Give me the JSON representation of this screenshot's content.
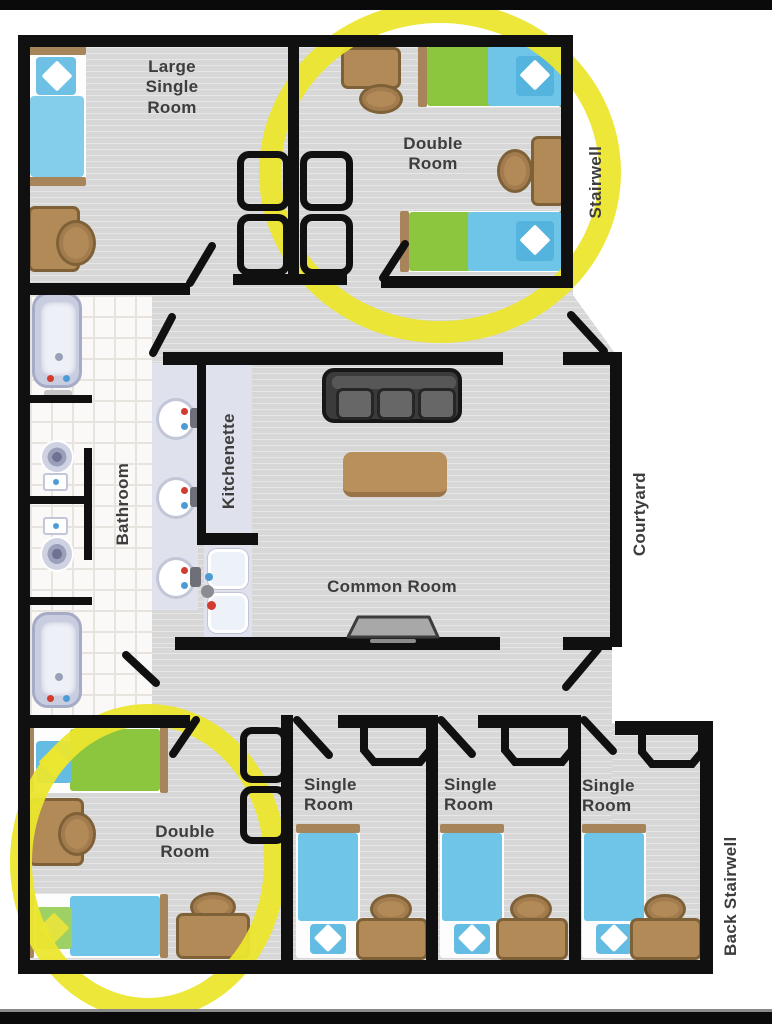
{
  "title": "Dormitory floor plan",
  "palette": {
    "wall": "#101010",
    "floor_gray": "#d7d7d8",
    "bathroom_tile": "#faf9f7",
    "counter_lavender": "#dfe1ec",
    "bed_blue": "#6fc5e8",
    "blanket_green": "#8cc63f",
    "wood_brown": "#b28a58",
    "couch_gray": "#3b3b3b",
    "highlight_yellow": "#ebe62e"
  },
  "labels": {
    "large_single_room": "Large\nSingle\nRoom",
    "double_room_top": "Double\nRoom",
    "stairwell": "Stairwell",
    "bathroom": "Bathroom",
    "kitchenette": "Kitchenette",
    "common_room": "Common Room",
    "courtyard": "Courtyard",
    "double_room_bottom": "Double\nRoom",
    "single_room_1": "Single\nRoom",
    "single_room_2": "Single\nRoom",
    "single_room_3": "Single\nRoom",
    "back_stairwell": "Back Stairwell"
  },
  "annotations": {
    "highlight_color": "#ebe62e",
    "highlighted_rooms": [
      "double_room_top",
      "double_room_bottom"
    ]
  }
}
